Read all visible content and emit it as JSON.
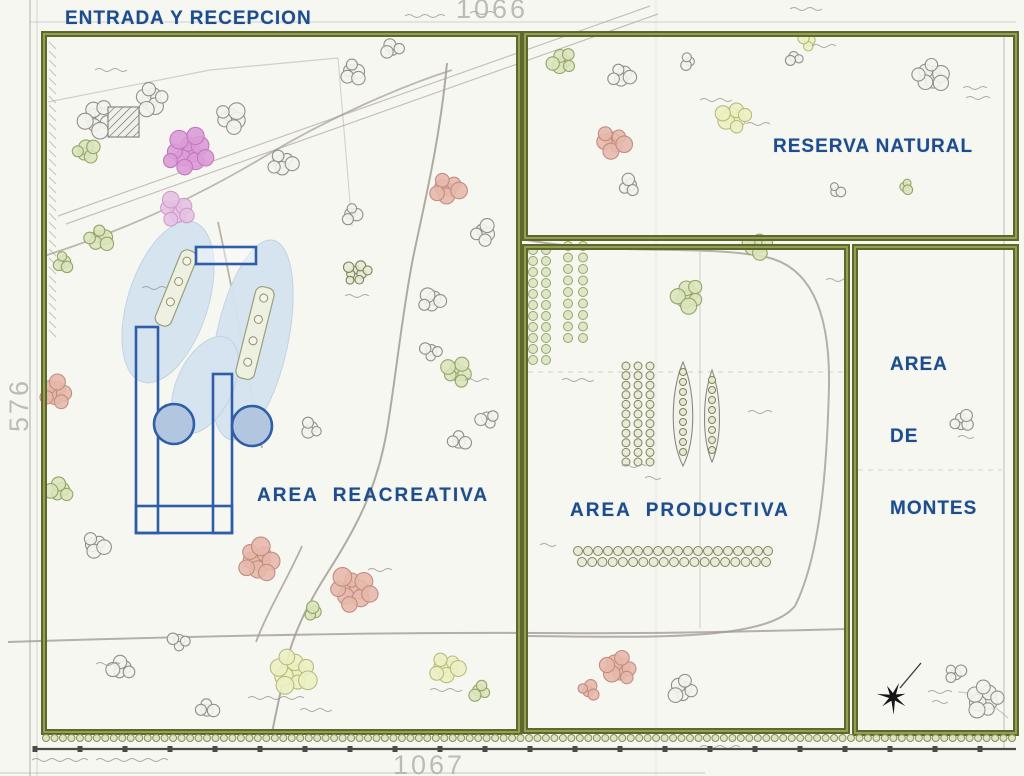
{
  "labels": {
    "entrada": "ENTRADA Y RECEPCION",
    "reserva": "RESERVA NATURAL",
    "recreativa": "AREA  REACREATIVA",
    "productiva": "AREA  PRODUCTIVA",
    "montes": [
      "AREA",
      "DE",
      "MONTES"
    ],
    "sheet_top": "1066",
    "sheet_bottom": "1067",
    "sheet_left": "576"
  },
  "palette": {
    "paper": "#f7f7f2",
    "boundary": "#5d682a",
    "boundary_light": "#9aa45a",
    "label_blue": "#1d4d8c",
    "blue": "#2e5ea8",
    "blue_fill": "#b3c6e0",
    "water": "#d5e4f0",
    "water_edge": "#c0d2e2",
    "road": "#a29d92",
    "sheet_grey": "#9a9a93",
    "ink": "#151515"
  },
  "tree_colors": {
    "grey": {
      "s": "#90908a",
      "f": "#f3f3ed"
    },
    "green": {
      "s": "#96a468",
      "f": "#d9e4bd"
    },
    "yellow": {
      "s": "#b8bc7c",
      "f": "#ecefc2"
    },
    "salmon": {
      "s": "#c28d7f",
      "f": "#e5b8ab"
    },
    "magenta": {
      "s": "#c476c0",
      "f": "#da9bd6"
    },
    "pink": {
      "s": "#cf9ccb",
      "f": "#e6c0e3"
    },
    "olive": {
      "s": "#7e8459",
      "f": "#e7e8d4"
    },
    "hedge": {
      "s": "#85905c",
      "f": "#d8e0bc"
    }
  },
  "map": {
    "zones": [
      {
        "id": "entrada-recreativa",
        "x": 44,
        "y": 34,
        "w": 475,
        "h": 698
      },
      {
        "id": "reserva-natural",
        "x": 525,
        "y": 34,
        "w": 491,
        "h": 204
      },
      {
        "id": "area-productiva",
        "x": 525,
        "y": 247,
        "w": 322,
        "h": 484
      },
      {
        "id": "area-de-montes",
        "x": 855,
        "y": 247,
        "w": 161,
        "h": 486
      }
    ],
    "sheet_lines": [
      {
        "d": "M30,0 L30,776",
        "w": 1.4,
        "o": 0.55
      },
      {
        "d": "M37,0 L37,776",
        "w": 0.8,
        "o": 0.45
      },
      {
        "d": "M30,22 L1016,22",
        "w": 1.0,
        "o": 0.4
      },
      {
        "d": "M1004,35 L1004,750",
        "w": 1.2,
        "o": 0.5
      },
      {
        "d": "M656,0 L656,776",
        "w": 3.0,
        "o": 0.07
      },
      {
        "d": "M0,773 L705,773",
        "w": 1.0,
        "o": 0.5
      }
    ],
    "roads": [
      {
        "d": "M447,63 C440,140 424,205 413,258 C402,315 398,360 388,424 C378,488 356,528 328,572 C310,600 298,624 290,650 C285,672 278,702 272,733",
        "w": 2.0,
        "o": 0.85
      },
      {
        "d": "M8,642 C200,636 400,632 540,633 C660,634 760,631 847,629",
        "w": 2.0,
        "o": 0.8
      },
      {
        "d": "M302,546 C288,578 268,610 256,642",
        "w": 1.8,
        "o": 0.8
      },
      {
        "d": "M44,256 C120,232 195,198 262,158 C332,116 402,86 452,70",
        "w": 1.8,
        "o": 0.7
      },
      {
        "d": "M58,216 L650,6",
        "w": 1.2,
        "o": 0.6
      },
      {
        "d": "M66,224 L658,14",
        "w": 1.2,
        "o": 0.6
      },
      {
        "d": "M527,240 C615,256 700,244 766,257 C816,268 830,322 829,386 C827,470 820,556 795,606 C766,642 645,637 527,636",
        "w": 2.0,
        "o": 0.8
      },
      {
        "d": "M218,222 C231,282 246,362 262,448",
        "w": 1.8,
        "o": 0.75
      },
      {
        "d": "M700,252 L700,628",
        "w": 1.2,
        "o": 0.4
      },
      {
        "d": "M528,372 L845,372",
        "w": 1.2,
        "o": 0.35,
        "dash": "5,5"
      },
      {
        "d": "M858,470 L1002,470",
        "w": 1.2,
        "o": 0.3,
        "dash": "5,5"
      },
      {
        "d": "M900,688 L921,663",
        "w": 1.3,
        "o": 0.9,
        "color": "#222222"
      },
      {
        "d": "M48,102 L210,70 L338,58",
        "w": 1.2,
        "o": 0.45
      },
      {
        "d": "M338,58 L352,226",
        "w": 1.2,
        "o": 0.4
      },
      {
        "d": "M1008,718 C988,700 972,692 958,692",
        "w": 1.2,
        "o": 0.5
      }
    ],
    "water": [
      {
        "cx": 168,
        "cy": 302,
        "rx": 40,
        "ry": 84,
        "rot": 18
      },
      {
        "cx": 252,
        "cy": 340,
        "rx": 36,
        "ry": 102,
        "rot": 12
      },
      {
        "cx": 205,
        "cy": 385,
        "rx": 28,
        "ry": 52,
        "rot": 25
      }
    ],
    "islands": [
      {
        "cx": 176,
        "cy": 288,
        "w": 17,
        "h": 80,
        "rot": 22
      },
      {
        "cx": 255,
        "cy": 333,
        "w": 19,
        "h": 94,
        "rot": 14
      }
    ],
    "blue": {
      "rects": [
        {
          "x": 196,
          "y": 247,
          "w": 60,
          "h": 17,
          "f": 1
        },
        {
          "x": 136,
          "y": 327,
          "w": 22,
          "h": 206,
          "f": 0
        },
        {
          "x": 213,
          "y": 374,
          "w": 19,
          "h": 159,
          "f": 0
        },
        {
          "x": 136,
          "y": 506,
          "w": 96,
          "h": 27,
          "f": 0
        }
      ],
      "circles": [
        {
          "x": 174,
          "y": 424,
          "r": 20
        },
        {
          "x": 252,
          "y": 426,
          "r": 20
        }
      ]
    },
    "tree_clusters": [
      [
        97,
        118,
        8,
        15,
        "grey",
        8
      ],
      [
        86,
        152,
        5,
        10,
        "green",
        7
      ],
      [
        152,
        100,
        7,
        13,
        "grey",
        8
      ],
      [
        188,
        153,
        11,
        21,
        "magenta",
        9
      ],
      [
        175,
        210,
        7,
        14,
        "pink",
        8
      ],
      [
        232,
        118,
        6,
        12,
        "grey",
        8
      ],
      [
        283,
        162,
        6,
        11,
        "grey",
        7
      ],
      [
        352,
        72,
        5,
        10,
        "grey",
        7
      ],
      [
        393,
        48,
        4,
        8,
        "grey",
        6
      ],
      [
        448,
        188,
        7,
        13,
        "salmon",
        8
      ],
      [
        483,
        232,
        5,
        10,
        "grey",
        7
      ],
      [
        100,
        238,
        6,
        11,
        "green",
        7
      ],
      [
        62,
        262,
        4,
        8,
        "green",
        6
      ],
      [
        352,
        215,
        4,
        8,
        "grey",
        6
      ],
      [
        357,
        272,
        8,
        12,
        "olive",
        5
      ],
      [
        432,
        300,
        5,
        10,
        "grey",
        7
      ],
      [
        458,
        372,
        7,
        12,
        "green",
        7
      ],
      [
        487,
        420,
        4,
        8,
        "grey",
        6
      ],
      [
        310,
        428,
        4,
        8,
        "grey",
        6
      ],
      [
        55,
        392,
        7,
        13,
        "salmon",
        8
      ],
      [
        60,
        490,
        5,
        10,
        "green",
        7
      ],
      [
        95,
        545,
        5,
        10,
        "grey",
        7
      ],
      [
        258,
        560,
        9,
        17,
        "salmon",
        9
      ],
      [
        352,
        590,
        10,
        19,
        "salmon",
        9
      ],
      [
        313,
        612,
        3,
        6,
        "green",
        6
      ],
      [
        292,
        672,
        10,
        19,
        "yellow",
        9
      ],
      [
        178,
        642,
        4,
        8,
        "grey",
        6
      ],
      [
        122,
        668,
        5,
        10,
        "grey",
        7
      ],
      [
        447,
        667,
        7,
        13,
        "yellow",
        8
      ],
      [
        480,
        692,
        4,
        8,
        "green",
        6
      ],
      [
        208,
        708,
        4,
        8,
        "grey",
        6
      ],
      [
        430,
        352,
        4,
        8,
        "grey",
        6
      ],
      [
        460,
        440,
        4,
        8,
        "grey",
        6
      ],
      [
        562,
        62,
        6,
        11,
        "green",
        7
      ],
      [
        622,
        75,
        5,
        10,
        "grey",
        7
      ],
      [
        733,
        118,
        7,
        13,
        "yellow",
        8
      ],
      [
        612,
        142,
        7,
        13,
        "salmon",
        8
      ],
      [
        628,
        185,
        4,
        8,
        "grey",
        6
      ],
      [
        795,
        58,
        3,
        6,
        "grey",
        5
      ],
      [
        808,
        42,
        3,
        7,
        "yellow",
        6
      ],
      [
        932,
        75,
        8,
        14,
        "grey",
        8
      ],
      [
        906,
        186,
        3,
        5,
        "green",
        5
      ],
      [
        836,
        190,
        3,
        6,
        "grey",
        5
      ],
      [
        688,
        62,
        3,
        6,
        "grey",
        5
      ],
      [
        688,
        295,
        7,
        13,
        "green",
        8
      ],
      [
        757,
        246,
        6,
        11,
        "green",
        7
      ],
      [
        620,
        668,
        8,
        14,
        "salmon",
        8
      ],
      [
        683,
        690,
        6,
        11,
        "grey",
        7
      ],
      [
        590,
        690,
        4,
        8,
        "salmon",
        6
      ],
      [
        962,
        422,
        5,
        9,
        "grey",
        6
      ],
      [
        985,
        700,
        9,
        15,
        "grey",
        8
      ],
      [
        955,
        672,
        4,
        8,
        "grey",
        6
      ]
    ],
    "tree_rows": [
      {
        "x1": 533,
        "y1": 250,
        "x2": 533,
        "y2": 360,
        "step": 11,
        "r": 4.5,
        "c": "green"
      },
      {
        "x1": 546,
        "y1": 250,
        "x2": 546,
        "y2": 360,
        "step": 11,
        "r": 4.5,
        "c": "green"
      },
      {
        "x1": 568,
        "y1": 246,
        "x2": 568,
        "y2": 338,
        "step": 11,
        "r": 4.5,
        "c": "green"
      },
      {
        "x1": 583,
        "y1": 246,
        "x2": 583,
        "y2": 338,
        "step": 11,
        "r": 4.5,
        "c": "green"
      },
      {
        "x1": 626,
        "y1": 366,
        "x2": 626,
        "y2": 462,
        "step": 10,
        "r": 4,
        "c": "olive"
      },
      {
        "x1": 638,
        "y1": 366,
        "x2": 638,
        "y2": 462,
        "step": 10,
        "r": 4,
        "c": "olive"
      },
      {
        "x1": 650,
        "y1": 366,
        "x2": 650,
        "y2": 462,
        "step": 10,
        "r": 4,
        "c": "olive"
      },
      {
        "x1": 578,
        "y1": 551,
        "x2": 768,
        "y2": 551,
        "step": 10,
        "r": 4.5,
        "c": "olive"
      },
      {
        "x1": 582,
        "y1": 562,
        "x2": 766,
        "y2": 562,
        "step": 10,
        "r": 4.5,
        "c": "olive"
      }
    ],
    "hedge": {
      "x1": 46,
      "y1": 738,
      "x2": 1012,
      "y2": 738,
      "step": 8.5,
      "r": 3.5,
      "c": "hedge"
    },
    "spindles": [
      {
        "cx": 683,
        "top": 362,
        "bot": 466,
        "rx": 13
      },
      {
        "cx": 712,
        "top": 370,
        "bot": 462,
        "rx": 10
      }
    ],
    "buildings": [
      {
        "x": 108,
        "y": 107,
        "w": 31,
        "h": 30
      }
    ],
    "left_hatch": {
      "x": 49,
      "y1": 42,
      "y2": 332,
      "step": 9,
      "len": 7
    },
    "squiggles": [
      [
        95,
        70,
        34
      ],
      [
        405,
        16,
        40
      ],
      [
        470,
        13,
        24
      ],
      [
        790,
        9,
        28
      ],
      [
        746,
        124,
        20
      ],
      [
        700,
        100,
        28
      ],
      [
        812,
        46,
        20
      ],
      [
        963,
        88,
        26
      ],
      [
        966,
        98,
        20
      ],
      [
        248,
        698,
        55
      ],
      [
        300,
        710,
        28
      ],
      [
        430,
        690,
        34
      ],
      [
        96,
        664,
        26
      ],
      [
        562,
        380,
        28
      ],
      [
        622,
        466,
        26
      ],
      [
        645,
        478,
        18
      ],
      [
        748,
        412,
        22
      ],
      [
        826,
        280,
        24
      ],
      [
        958,
        437,
        18
      ],
      [
        928,
        692,
        26
      ],
      [
        932,
        702,
        18
      ],
      [
        32,
        760,
        52
      ],
      [
        96,
        760,
        70
      ],
      [
        700,
        747,
        36
      ],
      [
        142,
        288,
        22
      ],
      [
        345,
        296,
        22
      ],
      [
        465,
        380,
        24
      ],
      [
        368,
        570,
        24
      ],
      [
        540,
        545,
        16
      ]
    ],
    "star": {
      "cx": 893,
      "cy": 697,
      "rO": 16,
      "rI": 4,
      "points": 7,
      "rot": -15
    },
    "scale": {
      "y": 749,
      "x1": 35,
      "x2": 1016,
      "step": 45
    }
  }
}
